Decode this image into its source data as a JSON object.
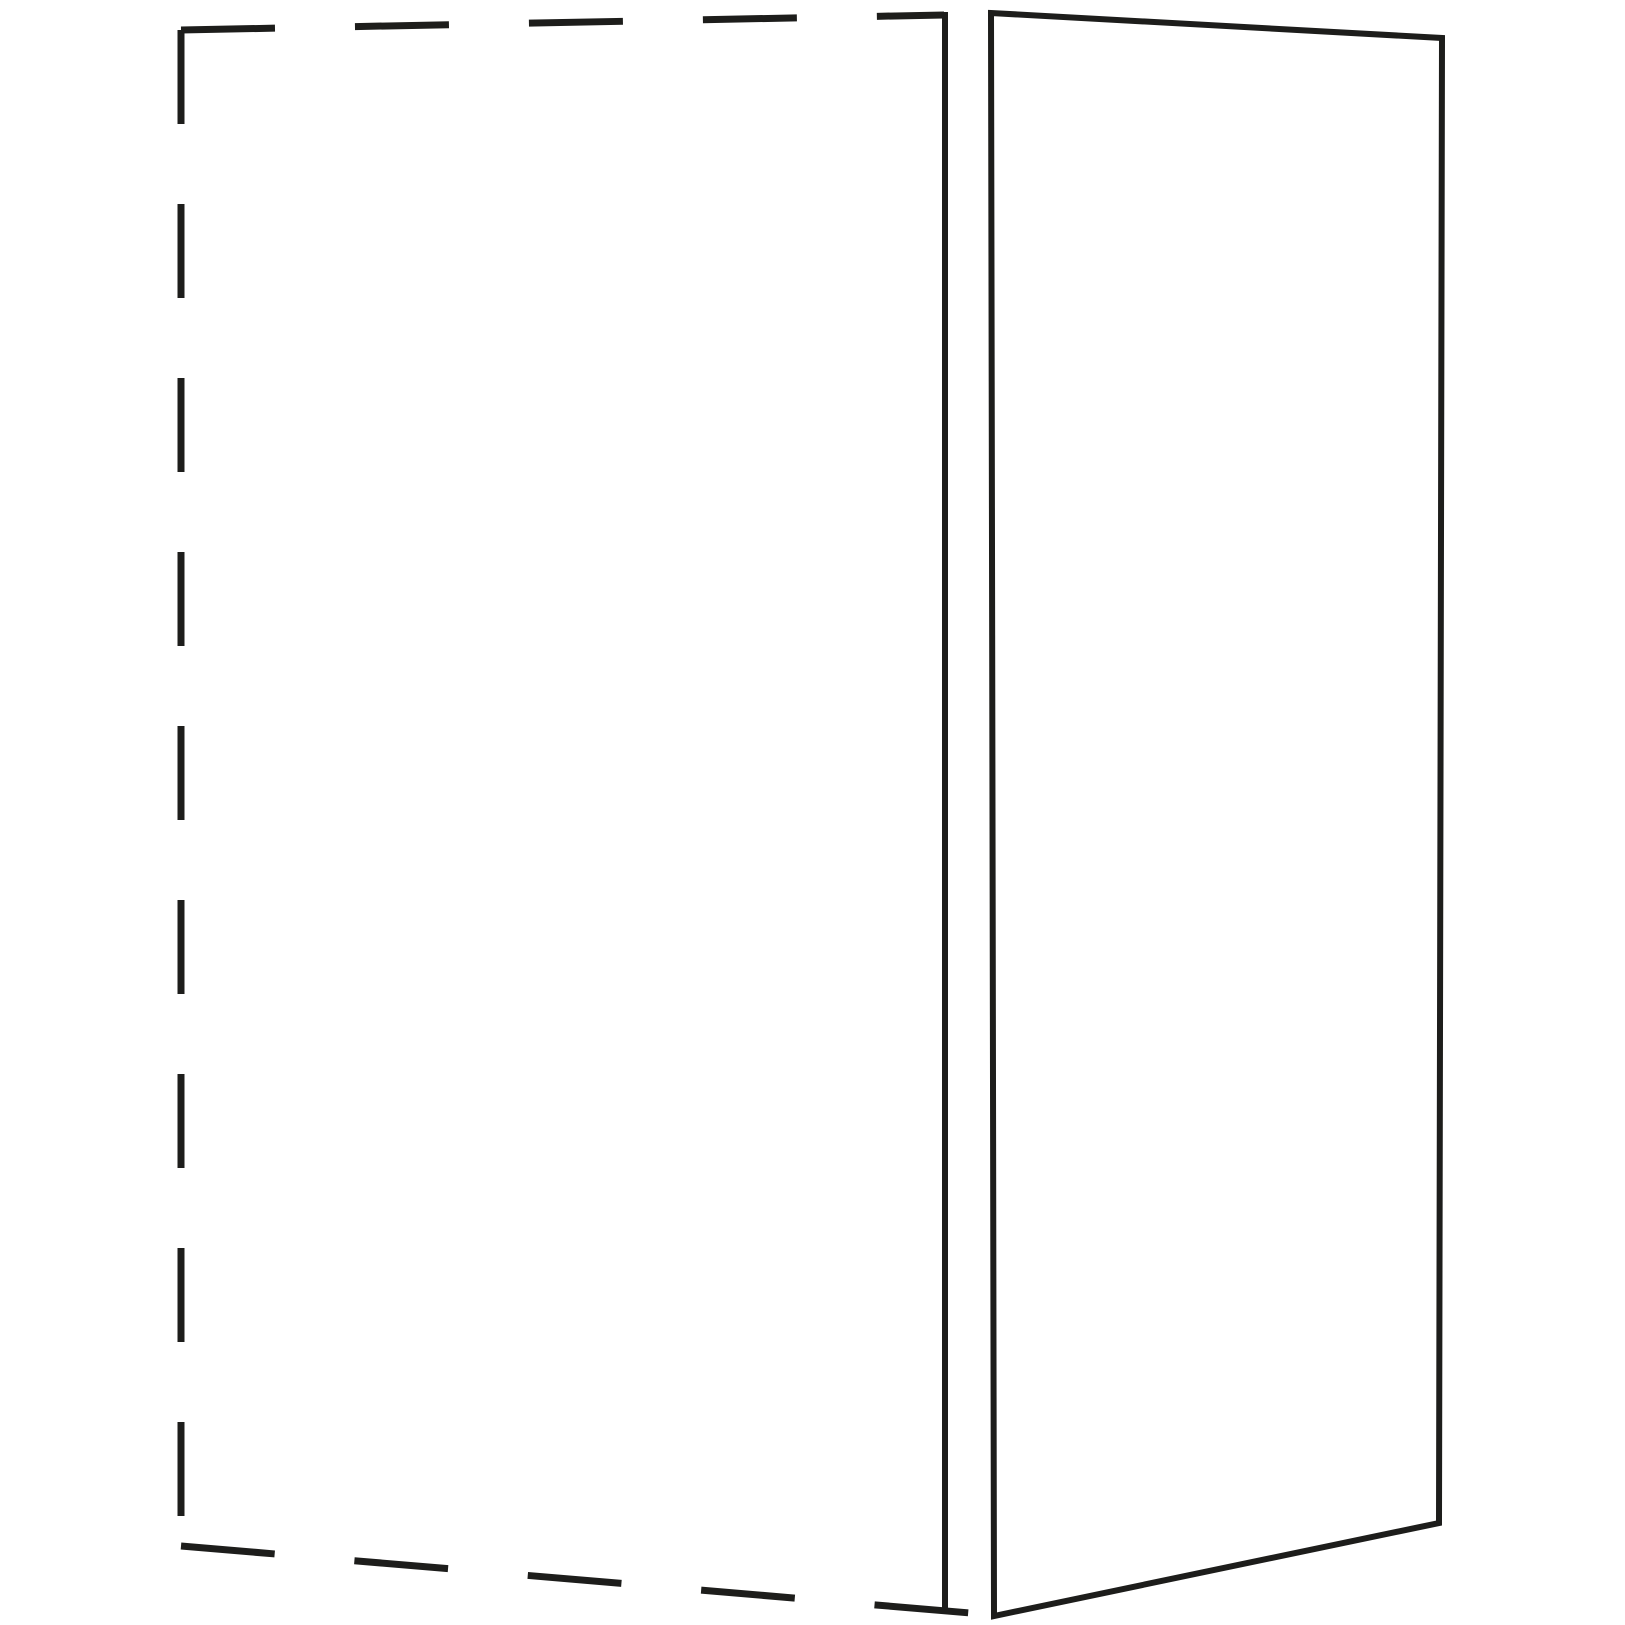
{
  "canvas": {
    "width": 1625,
    "height": 1625,
    "background_color": "#ffffff",
    "line_color": "#1d1d1b"
  },
  "diagram": {
    "styles": {
      "hidden": {
        "stroke_width": 7,
        "dash_array": "94 80",
        "linecap": "butt"
      },
      "solid": {
        "stroke_width": 6,
        "dash_array": "",
        "linecap": "square"
      }
    },
    "shapes": [
      {
        "name": "hidden-cabinet-top-edge",
        "type": "line",
        "style": "hidden",
        "x1": 181,
        "y1": 30,
        "x2": 944,
        "y2": 15
      },
      {
        "name": "hidden-cabinet-left-edge",
        "type": "line",
        "style": "hidden",
        "x1": 181,
        "y1": 30,
        "x2": 181,
        "y2": 1546
      },
      {
        "name": "hidden-cabinet-bottom-edge",
        "type": "line",
        "style": "hidden",
        "x1": 181,
        "y1": 1546,
        "x2": 994,
        "y2": 1615
      },
      {
        "name": "side-panel-back-edge",
        "type": "line",
        "style": "solid",
        "x1": 945,
        "y1": 15,
        "x2": 945,
        "y2": 1611
      },
      {
        "name": "side-panel-face-outline",
        "type": "polygon",
        "style": "solid",
        "points": [
          [
            991,
            13
          ],
          [
            1442,
            38
          ],
          [
            1439,
            1523
          ],
          [
            994,
            1616
          ]
        ],
        "closed": true
      }
    ]
  }
}
